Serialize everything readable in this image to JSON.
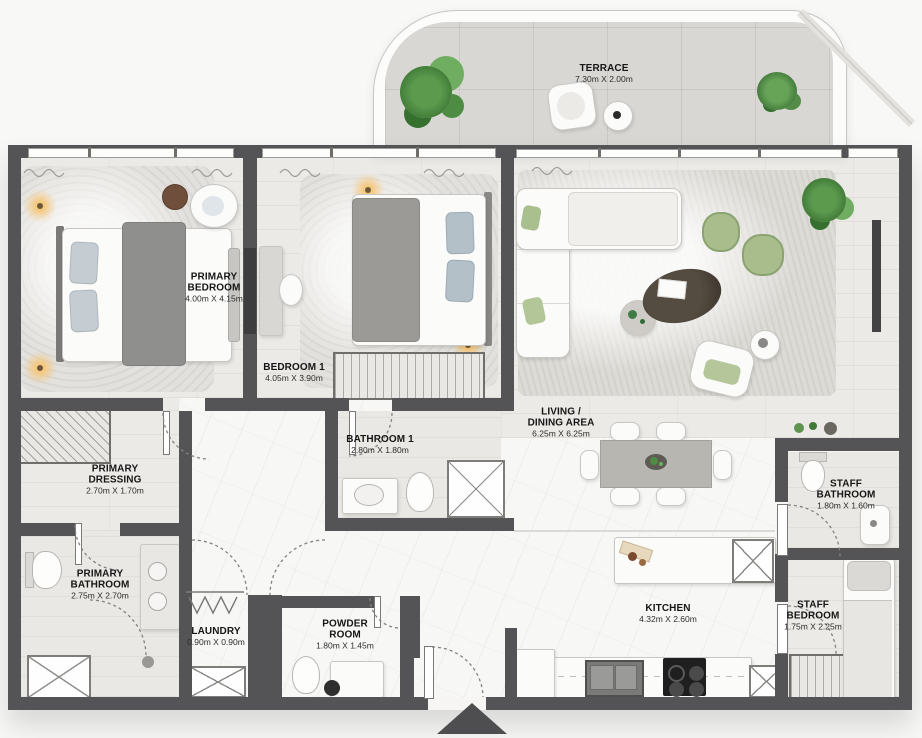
{
  "rooms": [
    {
      "id": "terrace",
      "name": "TERRACE",
      "dims": "7.30m X 2.00m"
    },
    {
      "id": "primary-bedroom",
      "name": "PRIMARY\nBEDROOM",
      "dims": "4.00m X 4.15m"
    },
    {
      "id": "bedroom-1",
      "name": "BEDROOM 1",
      "dims": "4.05m X 3.90m"
    },
    {
      "id": "bathroom-1",
      "name": "BATHROOM 1",
      "dims": "2.80m X 1.80m"
    },
    {
      "id": "living-dining",
      "name": "LIVING /\nDINING AREA",
      "dims": "6.25m X 6.25m"
    },
    {
      "id": "primary-dressing",
      "name": "PRIMARY\nDRESSING",
      "dims": "2.70m X 1.70m"
    },
    {
      "id": "primary-bathroom",
      "name": "PRIMARY\nBATHROOM",
      "dims": "2.75m X 2.70m"
    },
    {
      "id": "staff-bathroom",
      "name": "STAFF\nBATHROOM",
      "dims": "1.80m X 1.60m"
    },
    {
      "id": "laundry",
      "name": "LAUNDRY",
      "dims": "0.90m X 0.90m"
    },
    {
      "id": "powder-room",
      "name": "POWDER\nROOM",
      "dims": "1.80m X 1.45m"
    },
    {
      "id": "kitchen",
      "name": "KITCHEN",
      "dims": "4.32m X 2.60m"
    },
    {
      "id": "staff-bedroom",
      "name": "STAFF\nBEDROOM",
      "dims": "1.75m X 2.25m"
    }
  ],
  "icons": {
    "entrance_arrow": "triangle-up"
  },
  "colors": {
    "wall": "#545356",
    "accent_green": "#a8bd8b",
    "plant_green": "#4e8c43",
    "lamp_glow": "#f5c578",
    "floor_wood": "#eceae6",
    "floor_marble": "#f7f7f5",
    "terrace_floor": "#d8d7d3"
  }
}
